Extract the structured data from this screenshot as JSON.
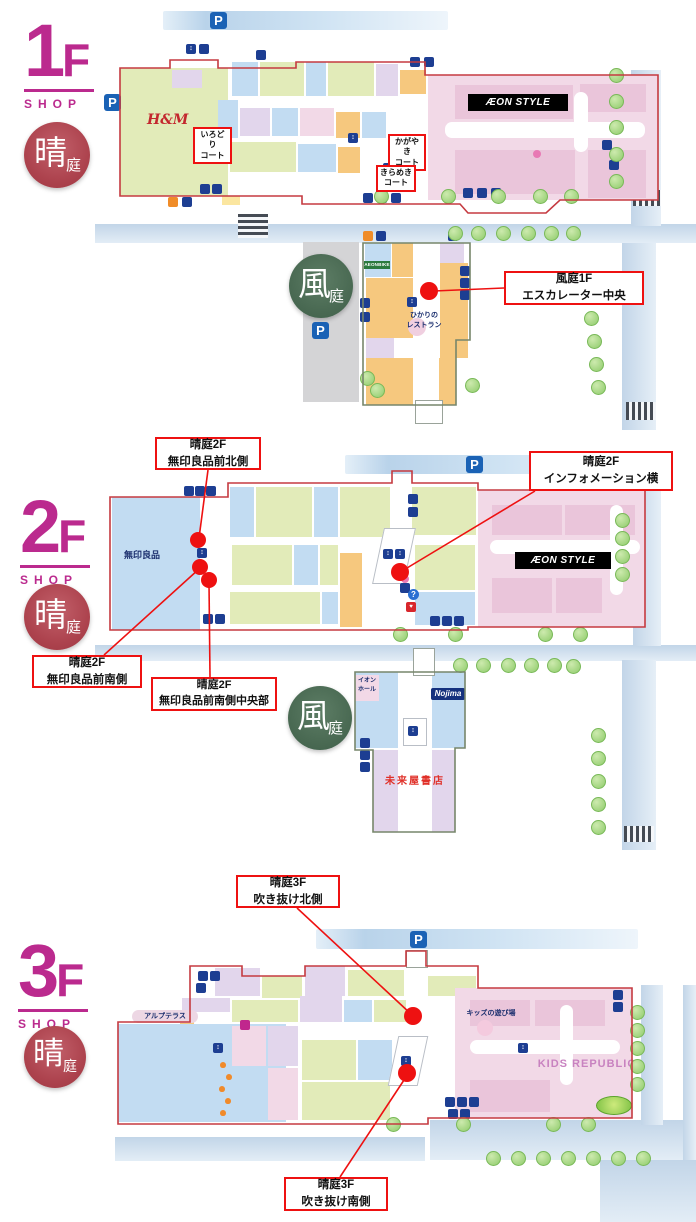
{
  "shared": {
    "parking": "P",
    "shop": "SHOP",
    "aeon_style": "ÆON STYLE",
    "hare_big": "晴",
    "hare_small": "庭",
    "kaze_big": "風",
    "kaze_small": "庭"
  },
  "f1": {
    "num": "1",
    "suffix": "F",
    "hm": "H&M",
    "irodori": "いろどり\nコート",
    "kagayaki": "かがやき\nコート",
    "kirameki": "きらめき\nコート",
    "aeon_bike": "AEONBIKE",
    "restaurant": "ひかりの\nレストラン",
    "callout_escalator": "風庭1F\nエスカレーター中央"
  },
  "f2": {
    "num": "2",
    "suffix": "F",
    "muji": "無印良品",
    "aeon_hall": "イオン\nホール",
    "nojima": "Nojima",
    "bookstore": "未来屋書店",
    "callout_muji_north": "晴庭2F\n無印良品前北側",
    "callout_info": "晴庭2F\nインフォメーション横",
    "callout_muji_south": "晴庭2F\n無印良品前南側",
    "callout_muji_south_center": "晴庭2F\n無印良品前南側中央部"
  },
  "f3": {
    "num": "3",
    "suffix": "F",
    "alp_terrace": "アルプテラス",
    "kids_playground": "キッズの遊び場",
    "kids_republic": "KIDS REPUBLIC",
    "callout_atrium_north": "晴庭3F\n吹き抜け北側",
    "callout_atrium_south": "晴庭3F\n吹き抜け南側"
  }
}
